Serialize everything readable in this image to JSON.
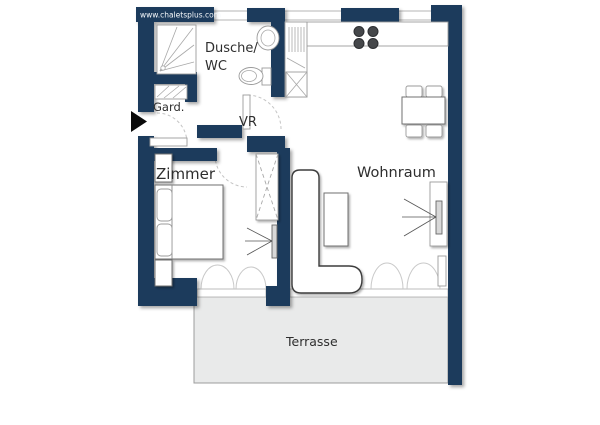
{
  "watermark": "www.chaletsplus.com",
  "labels": {
    "dusche_line1": "Dusche/",
    "dusche_line2": "WC",
    "gard": "Gard.",
    "vr": "VR",
    "zimmer": "Zimmer",
    "wohnraum": "Wohnraum",
    "terrasse": "Terrasse"
  },
  "icons": {
    "entrance_arrow": "▶"
  },
  "colors": {
    "wall_navy": "#1a3a5c",
    "label_text": "#2e2e2e",
    "watermark_text": "#f5f8fb",
    "terrace_fill": "#e9eaea",
    "terrace_border": "#9c9c9c",
    "furniture_fill": "#ffffff",
    "furniture_stroke": "#6f6f6f",
    "swing_arc": "#c4c4c4",
    "burner": "#45474a",
    "tv_fill": "#d8d8d8",
    "entrance_arrow": "#0a0a0a"
  }
}
